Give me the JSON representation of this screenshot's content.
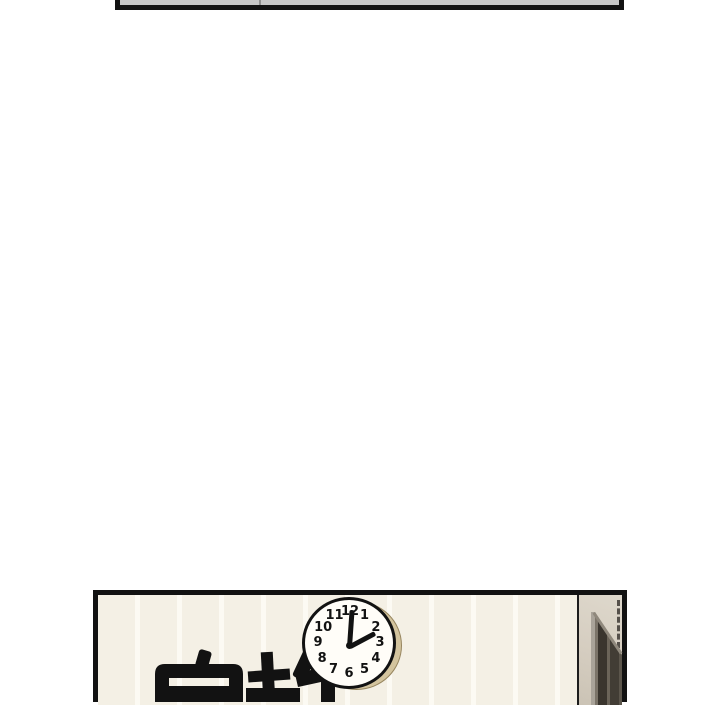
{
  "page": {
    "background_color": "#ffffff"
  },
  "panels": {
    "top_strip": {
      "interior_color": "#c7c7c7",
      "border_color": "#121212"
    },
    "classroom": {
      "border_color": "#121212",
      "wall_color": "#f4f0e5",
      "wall_stripe_color": "#fcfaf3",
      "wall_text": "安静",
      "clock": {
        "time_shown": "2:00",
        "numbers": [
          "1",
          "2",
          "3",
          "4",
          "5",
          "6",
          "7",
          "8",
          "9",
          "10",
          "11",
          "12"
        ],
        "face_color": "#fffdf8",
        "outline_color": "#121212",
        "rim_shadow_color": "#d3c49e",
        "minute_angle_deg": 4,
        "hour_angle_deg": 62
      },
      "door": {
        "wall_color": "#d5cdc0",
        "frame_dark_color": "#3a352e",
        "frame_light_color": "#a9a399",
        "partition_line_color": "#1c1c1c"
      }
    }
  }
}
